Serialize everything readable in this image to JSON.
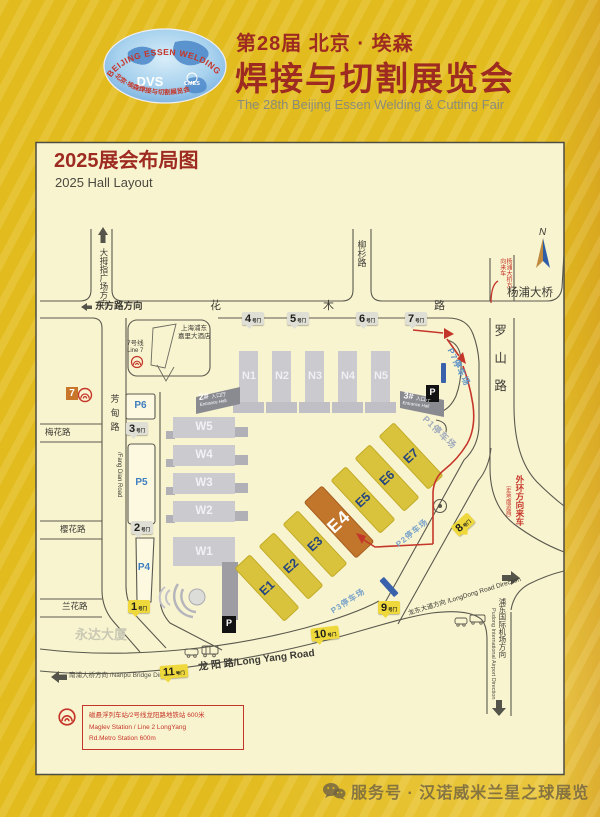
{
  "header": {
    "logo": {
      "arc_top": "BEIJING ESSEN WELDING & CUTTING",
      "dvs": "DVS",
      "cmes": "CMES",
      "arc_bottom": "北京·埃森焊接与切割展览会"
    },
    "title_line1": "第28届 北京 · 埃森",
    "title_line2": "焊接与切割展览会",
    "subtitle": "The 28th Beijing Essen Welding & Cutting Fair"
  },
  "map": {
    "title_cn": "2025展会布局图",
    "title_en": "2025 Hall Layout",
    "compass": "N",
    "roads": {
      "thumb_plaza": "大拇指广场方向",
      "dongfang": "东方路方向",
      "huamu": [
        "花",
        "木",
        "路"
      ],
      "liushan": "柳杉路",
      "yangpu_bridge": "杨浦大桥",
      "yangpu_incoming": "杨浦大桥方向来车",
      "luoshan": "罗山路",
      "fangdian_cn": "芳甸路",
      "fangdian_en": "/Fang Dian Road",
      "meihua": "梅花路",
      "yinghua": "樱花路",
      "lanhua": "兰花路",
      "longyang": "龙 阳 路/Long Yang Road",
      "nanpu": "南浦大桥方向 /Nanpu Bridge Direction",
      "longdong": "龙东大道方向 /LongDong Road Direction",
      "airport_cn": "浦东国际机场方向",
      "airport_en": "Pudong International Airport Direction",
      "waihuan": "外环方向来车",
      "waihuan_note": "（走地面道路）"
    },
    "buildings": {
      "hotel_line1": "上海浦东",
      "hotel_line2": "嘉里大酒店",
      "yongda": "永达大厦"
    },
    "line7": {
      "badge": "7",
      "cn": "7号线",
      "en": "Line 7"
    },
    "halls": {
      "n": [
        "N1",
        "N2",
        "N3",
        "N4",
        "N5"
      ],
      "w": [
        "W5",
        "W4",
        "W3",
        "W2",
        "W1"
      ],
      "e": [
        "E1",
        "E2",
        "E3",
        "E4",
        "E5",
        "E6",
        "E7"
      ]
    },
    "entrances": {
      "n2": "2#",
      "n3": "3#",
      "cn": "入口厅",
      "en": "Entrance Hall"
    },
    "parking": {
      "p6": "P6",
      "p5": "P5",
      "p4": "P4",
      "p7": "P7停车场",
      "p1": "P1停车场",
      "p2": "P2停车场",
      "p3": "P3停车场",
      "icon": "P"
    },
    "gates": {
      "suffix": "号门",
      "g1": "1",
      "g2": "2",
      "g3": "3",
      "g4": "4",
      "g5": "5",
      "g6": "6",
      "g7": "7",
      "g8": "8",
      "g9": "9",
      "g10": "10",
      "g11": "11"
    },
    "note": {
      "line1": "磁悬浮列车站/2号线龙阳路地铁站 600米",
      "line2": "Maglev Station / Line 2 LongYang",
      "line3": "Rd.Metro Station 600m"
    },
    "colors": {
      "accent_red": "#C5362A",
      "gate_yellow": "#EED83C",
      "hall_gold": "#D9C23C",
      "hall_highlight": "#C1762C",
      "hall_gray": "#CACACF",
      "panel_bg": "#F9F4D0",
      "page_gold": "#E2BB1E"
    }
  },
  "footer": {
    "account": "服务号 · 汉诺威米兰星之球展览"
  }
}
